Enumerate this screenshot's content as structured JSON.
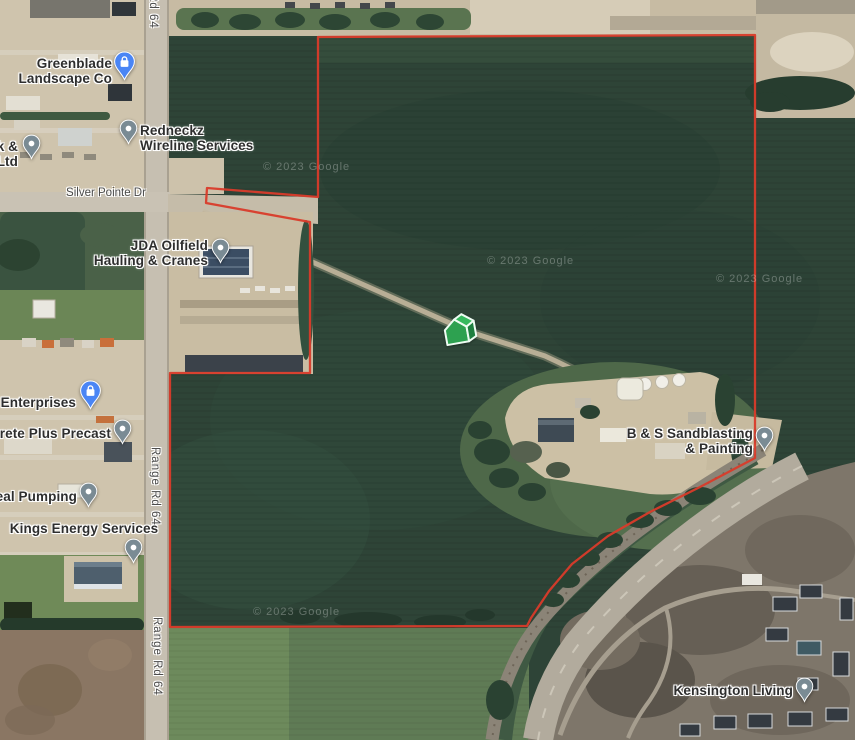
{
  "map": {
    "view_type": "satellite",
    "boundary": {
      "color": "#d93b2a",
      "description": "red parcel boundary outline"
    },
    "marker": {
      "name": "green-3d-house-marker",
      "color": "#2da150"
    },
    "places": [
      {
        "label": "Greenblade\nLandscape Co",
        "pin": "blue-shopping"
      },
      {
        "label": "k &\nLtd",
        "pin": "gray"
      },
      {
        "label": "Redneckz\nWireline Services",
        "pin": "gray"
      },
      {
        "label": "JDA Oilfield\nHauling & Cranes",
        "pin": "gray"
      },
      {
        "label": "y Enterprises",
        "pin": "blue-shopping"
      },
      {
        "label": "crete Plus Precast",
        "pin": "gray"
      },
      {
        "label": "eal Pumping",
        "pin": "gray"
      },
      {
        "label": "Kings Energy Services",
        "pin": "gray"
      },
      {
        "label": "B & S Sandblasting\n& Painting",
        "pin": "gray"
      },
      {
        "label": "Kensington Living",
        "pin": "gray"
      }
    ],
    "road_labels": [
      {
        "text": "Range Rd 64"
      },
      {
        "text": "Silver Pointe Dr"
      },
      {
        "text": "Range Rd 64"
      },
      {
        "text": "Range Rd 64"
      }
    ],
    "watermarks": [
      {
        "text": "© 2023 Google"
      },
      {
        "text": "© 2023 Google"
      },
      {
        "text": "© 2023 Google"
      },
      {
        "text": "© 2023 Google"
      }
    ]
  }
}
